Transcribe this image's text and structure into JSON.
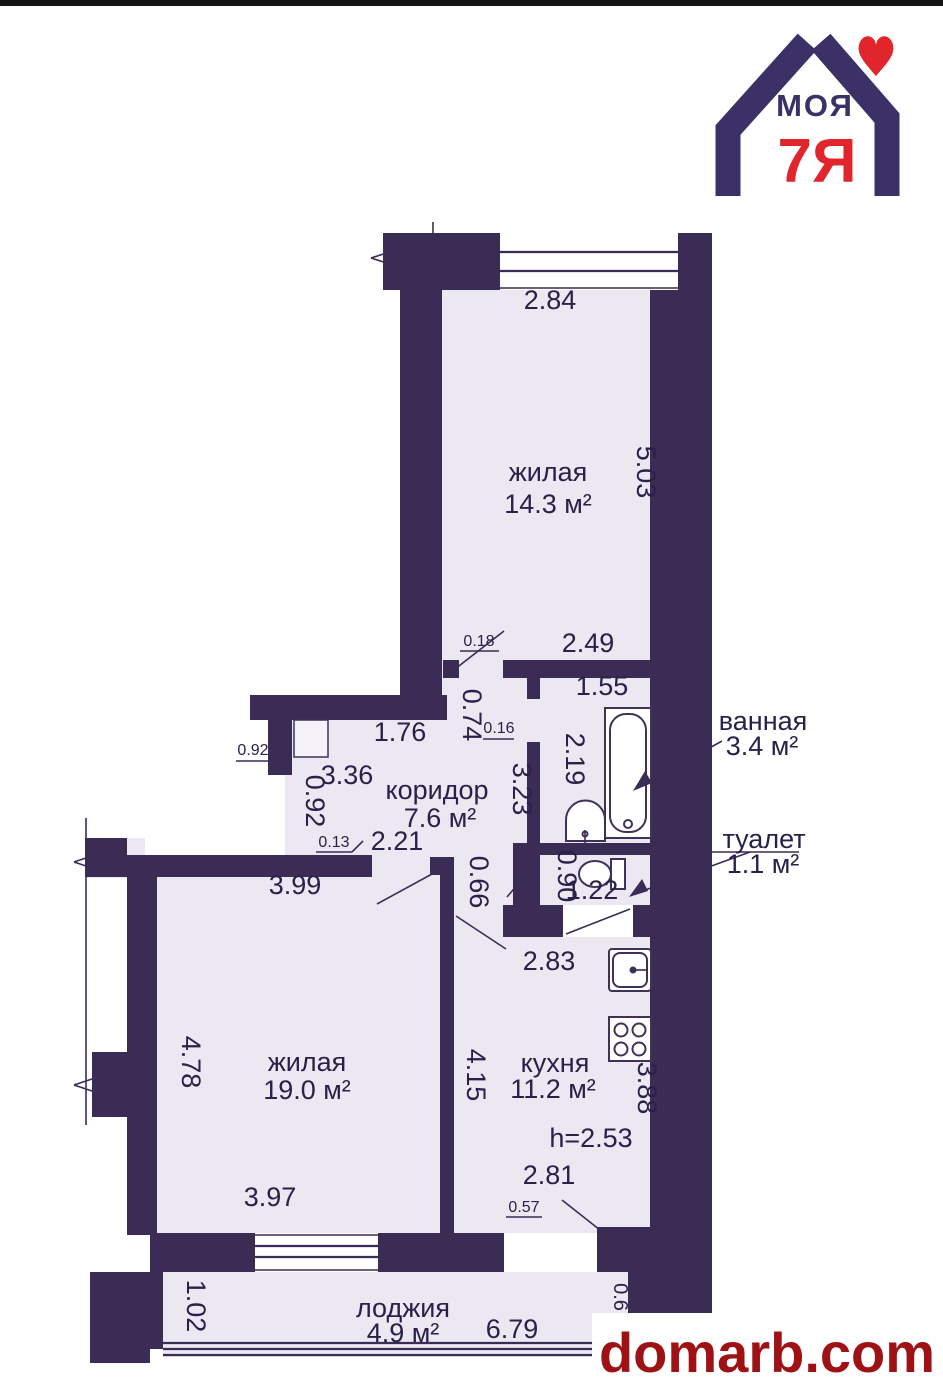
{
  "colors": {
    "wall": "#3a2c55",
    "floor": "#ebe8f2",
    "text": "#29214a",
    "logo_purple": "#3b3166",
    "logo_red": "#e0262c",
    "watermark_red": "#9e1215"
  },
  "logo": {
    "word": "МОЯ",
    "number": "7Я"
  },
  "watermark": {
    "text": "domarb.com"
  },
  "rooms": {
    "living1": {
      "name": "жилая",
      "area": "14.3 м²"
    },
    "bathroom": {
      "name": "ванная",
      "area": "3.4 м²"
    },
    "toilet": {
      "name": "туалет",
      "area": "1.1 м²"
    },
    "corridor": {
      "name": "коридор",
      "area": "7.6 м²"
    },
    "living2": {
      "name": "жилая",
      "area": "19.0 м²"
    },
    "kitchen": {
      "name": "кухня",
      "area": "11.2 м²"
    },
    "loggia": {
      "name": "лоджия",
      "area": "4.9 м²"
    }
  },
  "dims": {
    "d284": "2.84",
    "d503": "5.03",
    "d249": "2.49",
    "d018": "0.18",
    "d074": "0.74",
    "d155": "1.55",
    "d219": "2.19",
    "d016": "0.16",
    "d323": "3.23",
    "d176": "1.76",
    "d336": "3.36",
    "d092h": "0.92",
    "d092v": "0.92",
    "d013": "0.13",
    "d221": "2.21",
    "d399": "3.99",
    "d066": "0.66",
    "d090": "0.90",
    "d122": "1.22",
    "d283": "2.83",
    "d478": "4.78",
    "d415": "4.15",
    "d397": "3.97",
    "d388": "3.88",
    "dh253": "h=2.53",
    "d281": "2.81",
    "d057": "0.57",
    "d102": "1.02",
    "d679": "6.79",
    "d06": "0.6"
  }
}
